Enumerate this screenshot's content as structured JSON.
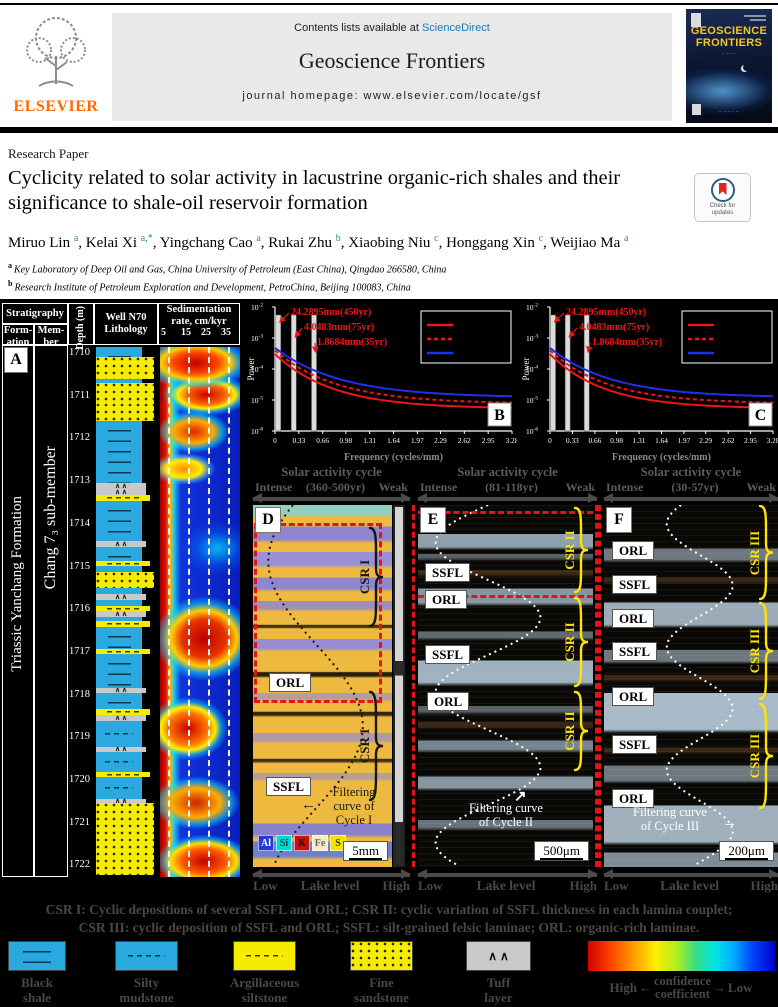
{
  "journal_header": {
    "contents_prefix": "Contents lists available at",
    "sciencedirect": "ScienceDirect",
    "journal_name": "Geoscience Frontiers",
    "homepage_line": "journal homepage: www.elsevier.com/locate/gsf",
    "publisher": "ELSEVIER",
    "cover_title_line1": "GEOSCIENCE",
    "cover_title_line2": "FRONTIERS"
  },
  "article": {
    "type_label": "Research Paper",
    "title": "Cyclicity related to solar activity in lacustrine organic-rich shales and their significance to shale-oil reservoir formation",
    "check_updates_line1": "Check for",
    "check_updates_line2": "updates",
    "authors": [
      {
        "name": "Miruo Lin",
        "sup": "a"
      },
      {
        "name": "Kelai Xi",
        "sup": "a,*"
      },
      {
        "name": "Yingchang Cao",
        "sup": "a"
      },
      {
        "name": "Rukai Zhu",
        "sup": "b"
      },
      {
        "name": "Xiaobing Niu",
        "sup": "c"
      },
      {
        "name": "Honggang Xin",
        "sup": "c"
      },
      {
        "name": "Weijiao Ma",
        "sup": "a"
      }
    ],
    "affiliations": [
      {
        "sup": "a",
        "text": "Key Laboratory of Deep Oil and Gas, China University of Petroleum (East China), Qingdao 266580, China"
      },
      {
        "sup": "b",
        "text": "Research Institute of Petroleum Exploration and Development, PetroChina, Beijing 100083, China"
      },
      {
        "sup": "c",
        "text": "PetroChina Changqing Oilfield Company, Xi'an 700018, China"
      }
    ]
  },
  "figure": {
    "panelA": {
      "label": "A",
      "headers": {
        "stratigraphy": "Stratigraphy",
        "formation": "Form-ation",
        "member": "Mem-ber",
        "depth": "Depth (m)",
        "lithology_l1": "Well N70",
        "lithology_l2": "Lithology",
        "sed_l1": "Sedimentation",
        "sed_l2": "rate, cm/kyr",
        "sed_ticks": [
          "5",
          "15",
          "25",
          "35"
        ]
      },
      "formation_text": "Triassic Yanchang Formation",
      "member_text": "Chang 7₃ sub-member",
      "depth_labels": [
        "1710",
        "1711",
        "1712",
        "1713",
        "1714",
        "1715",
        "1716",
        "1717",
        "1718",
        "1719",
        "1720",
        "1721",
        "1722"
      ],
      "lithology_layers": [
        {
          "t": "bs",
          "h": 10
        },
        {
          "t": "fs",
          "h": 22
        },
        {
          "t": "bs",
          "h": 4
        },
        {
          "t": "fs",
          "h": 20
        },
        {
          "t": "fs",
          "h": 18
        },
        {
          "t": "bs",
          "h": 62
        },
        {
          "t": "tf",
          "h": 6
        },
        {
          "t": "tf",
          "h": 6
        },
        {
          "t": "as",
          "h": 6
        },
        {
          "t": "bs",
          "h": 40
        },
        {
          "t": "tf",
          "h": 6
        },
        {
          "t": "bs",
          "h": 14
        },
        {
          "t": "as",
          "h": 5
        },
        {
          "t": "bs",
          "h": 6
        },
        {
          "t": "fs",
          "h": 16
        },
        {
          "t": "bs",
          "h": 6
        },
        {
          "t": "tf",
          "h": 6
        },
        {
          "t": "bs",
          "h": 6
        },
        {
          "t": "as",
          "h": 5
        },
        {
          "t": "tf",
          "h": 6
        },
        {
          "t": "bs",
          "h": 4
        },
        {
          "t": "as",
          "h": 6
        },
        {
          "t": "bs",
          "h": 22
        },
        {
          "t": "as",
          "h": 5
        },
        {
          "t": "bs",
          "h": 34
        },
        {
          "t": "tf",
          "h": 5
        },
        {
          "t": "bs",
          "h": 16
        },
        {
          "t": "as",
          "h": 6
        },
        {
          "t": "tf",
          "h": 6
        },
        {
          "t": "sm",
          "h": 26
        },
        {
          "t": "tf",
          "h": 5
        },
        {
          "t": "sm",
          "h": 20
        },
        {
          "t": "as",
          "h": 5
        },
        {
          "t": "sm",
          "h": 22
        },
        {
          "t": "tf",
          "h": 4
        },
        {
          "t": "fs",
          "h": 72
        }
      ]
    },
    "micro_panels": [
      {
        "label": "D",
        "title": "Solar activity cycle",
        "range": "(360-500yr)",
        "intense": "Intense",
        "weak": "Weak",
        "boxes": [
          {
            "text": "ORL",
            "x": 16,
            "y": 168
          },
          {
            "text": "SSFL",
            "x": 13,
            "y": 272
          }
        ],
        "braces": [
          {
            "label": "CSR I",
            "y": 22,
            "h": 100
          },
          {
            "label": "CSR I",
            "y": 186,
            "h": 110
          }
        ],
        "note_lines": [
          "Filtering",
          "curve of",
          "Cycle I"
        ],
        "scale": "5mm",
        "elements": [
          {
            "sym": "Al",
            "bg": "#2238d8",
            "fg": "#ffffff"
          },
          {
            "sym": "Si",
            "bg": "#00d8d8",
            "fg": "#074a3a"
          },
          {
            "sym": "K",
            "bg": "#c81010",
            "fg": "#1a0000"
          },
          {
            "sym": "Fe",
            "bg": "#f2ecca",
            "fg": "#6a6a5a"
          },
          {
            "sym": "S",
            "bg": "#f2e200",
            "fg": "#4a3200"
          }
        ],
        "lake": {
          "low": "Low",
          "label": "Lake level",
          "high": "High"
        }
      },
      {
        "label": "E",
        "title": "Solar activity cycle",
        "range": "(81-118yr)",
        "intense": "Intense",
        "weak": "Weak",
        "boxes": [
          {
            "text": "SSFL",
            "x": 7,
            "y": 58
          },
          {
            "text": "ORL",
            "x": 7,
            "y": 85
          },
          {
            "text": "SSFL",
            "x": 7,
            "y": 140
          },
          {
            "text": "ORL",
            "x": 9,
            "y": 187
          }
        ],
        "braces": [
          {
            "label": "CSR II",
            "y": 2,
            "h": 86
          },
          {
            "label": "CSR II",
            "y": 92,
            "h": 90
          },
          {
            "label": "CSR II",
            "y": 186,
            "h": 80
          }
        ],
        "note_lines": [
          "Filtering curve",
          "of Cycle II"
        ],
        "scale": "500μm",
        "lake": {
          "low": "Low",
          "label": "Lake level",
          "high": "High"
        }
      },
      {
        "label": "F",
        "title": "Solar activity cycle",
        "range": "(30-57yr)",
        "intense": "Intense",
        "weak": "Weak",
        "boxes": [
          {
            "text": "ORL",
            "x": 8,
            "y": 36
          },
          {
            "text": "SSFL",
            "x": 8,
            "y": 70
          },
          {
            "text": "ORL",
            "x": 8,
            "y": 104
          },
          {
            "text": "SSFL",
            "x": 8,
            "y": 137
          },
          {
            "text": "ORL",
            "x": 8,
            "y": 182
          },
          {
            "text": "SSFL",
            "x": 8,
            "y": 230
          },
          {
            "text": "ORL",
            "x": 8,
            "y": 284
          }
        ],
        "braces": [
          {
            "label": "CSR III",
            "y": 0,
            "h": 95
          },
          {
            "label": "CSR III",
            "y": 97,
            "h": 98
          },
          {
            "label": "CSR III",
            "y": 198,
            "h": 106
          }
        ],
        "note_lines": [
          "Filtering curve",
          "of Cycle III"
        ],
        "scale": "200μm",
        "lake": {
          "low": "Low",
          "label": "Lake level",
          "high": "High"
        }
      }
    ],
    "caption_line1": "CSR I: Cyclic depositions of several SSFL and ORL; CSR II: cyclic variation of SSFL thickness in each lamina couplet;",
    "caption_line2": "CSR III:  cyclic deposition of SSFL and ORL; SSFL: silt-grained felsic laminae; ORL: organic-rich laminae.",
    "legend": {
      "items": [
        {
          "type": "bs",
          "label1": "Black",
          "label2": "shale"
        },
        {
          "type": "sm",
          "label1": "Silty",
          "label2": "mudstone"
        },
        {
          "type": "as",
          "label1": "Argillaceous",
          "label2": "siltstone"
        },
        {
          "type": "fs",
          "label1": "Fine",
          "label2": "sandstone"
        },
        {
          "type": "tf",
          "label1": "Tuff",
          "label2": "layer"
        }
      ],
      "colorbar": {
        "high": "High",
        "low": "Low",
        "mid_line1": "confidence",
        "mid_line2": "coefficient"
      }
    }
  },
  "chart_data": [
    {
      "type": "line",
      "title": "Power spectrum B",
      "panel_letter": "B",
      "xlabel": "Frequency (cycles/mm)",
      "ylabel": "Power",
      "x_ticks": [
        "0",
        "0.33",
        "0.66",
        "0.98",
        "1.31",
        "1.64",
        "1.97",
        "2.29",
        "2.62",
        "2.95",
        "3.28"
      ],
      "y_tick_exponents": [
        "-2",
        "-3",
        "-4",
        "-5",
        "-6"
      ],
      "xlim": [
        0,
        3.28
      ],
      "grid": false,
      "legend_position": "top-right",
      "series": [
        {
          "name": "red-solid",
          "color": "#f01414",
          "style": "solid"
        },
        {
          "name": "red-dashed",
          "color": "#f01414",
          "style": "dashed"
        },
        {
          "name": "blue-solid",
          "color": "#2030e8",
          "style": "solid"
        }
      ],
      "peaks_cycles_per_mm": [
        0.045,
        0.26,
        0.54
      ],
      "annotations": [
        "24.2895mm(450yr)",
        "4.0483mm(75yr)",
        "1.8684mm(35yr)"
      ]
    },
    {
      "type": "line",
      "title": "Power spectrum C",
      "panel_letter": "C",
      "xlabel": "Frequency (cycles/mm)",
      "ylabel": "Power",
      "x_ticks": [
        "0",
        "0.33",
        "0.66",
        "0.98",
        "1.31",
        "1.64",
        "1.97",
        "2.29",
        "2.62",
        "2.95",
        "3.28"
      ],
      "y_tick_exponents": [
        "-2",
        "-3",
        "-4",
        "-5",
        "-6"
      ],
      "xlim": [
        0,
        3.28
      ],
      "grid": false,
      "legend_position": "top-right",
      "series": [
        {
          "name": "red-solid",
          "color": "#f01414",
          "style": "solid"
        },
        {
          "name": "red-dashed",
          "color": "#f01414",
          "style": "dashed"
        },
        {
          "name": "blue-solid",
          "color": "#2030e8",
          "style": "solid"
        }
      ],
      "peaks_cycles_per_mm": [
        0.045,
        0.26,
        0.54
      ],
      "annotations": [
        "24.2895mm(450yr)",
        "4.0483mm(75yr)",
        "1.8684mm(35yr)"
      ]
    }
  ]
}
